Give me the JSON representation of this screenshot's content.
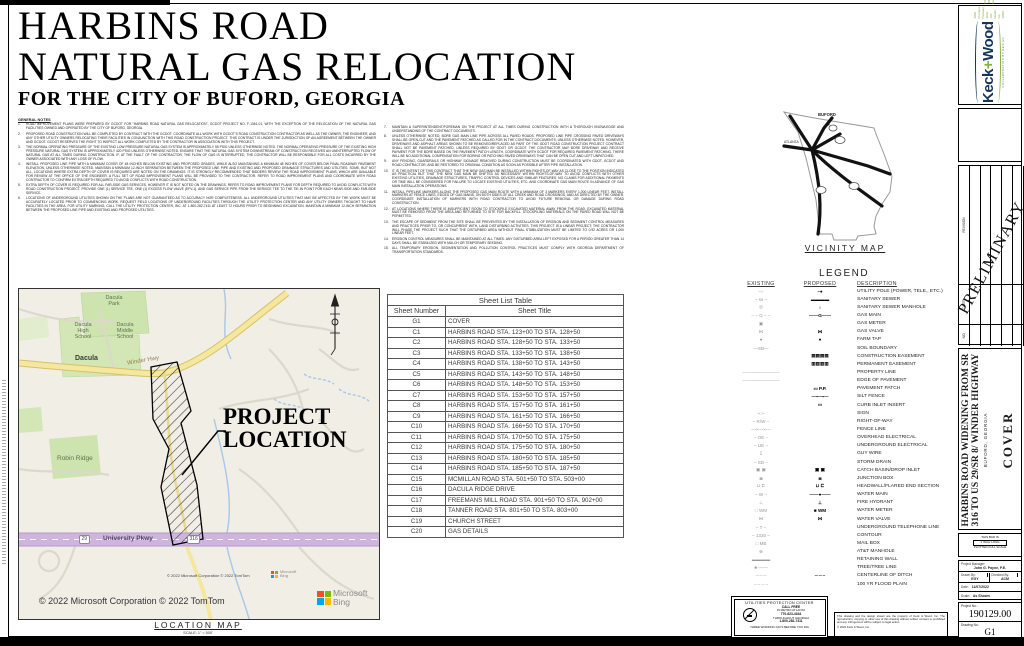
{
  "colors": {
    "keck_navy": "#15365a",
    "keck_green": "#86b33a",
    "map_hwy_yellow": "#f5e79e",
    "map_pkwy_purple": "#cfb5de",
    "park_green": "#cde4ae"
  },
  "sheet_title": {
    "line1": "HARBINS ROAD",
    "line2": "NATURAL GAS RELOCATION",
    "line3": "FOR THE CITY OF BUFORD, GEORGIA"
  },
  "general_notes": {
    "heading": "GENERAL NOTES",
    "col1": [
      {
        "n": "1.",
        "text": "ROAD IMPROVEMENT PLANS WERE PREPARED BY GCDOT FOR \"HARBINS ROAD NATURAL GAS RELOCATION\", GCDOT PROJECT NO. F-1361-01, WITH THE EXCEPTION OF THE RELOCATION OF THE NATURAL GAS FACILITIES OWNED AND OPERATED BY THE CITY OF BUFORD, GEORGIA."
      },
      {
        "n": "2.",
        "text": "PROPOSED ROAD CONSTRUCTION WILL BE COMPLETED BY CONTRACT WITH THE GCDOT. COORDINATE ALL WORK WITH GCDOT'S ROAD CONSTRUCTION CONTRACTOR AS WELL AS THE OWNER, THE ENGINEER, AND ANY OTHER UTILITY OWNERS RELOCATING THEIR FACILITIES IN CONJUNCTION WITH THIS ROAD CONSTRUCTION PROJECT. THIS CONTRACT IS UNDER THE JURISDICTION OF AN AGREEMENT BETWEEN THE OWNER AND GCDOT. GCDOT RESERVES THE RIGHT TO INSPECT ALL WORK COMPLETED BY THE CONTRACTOR IN ASSOCIATION WITH THIS PROJECT."
      },
      {
        "n": "3.",
        "text": "THE NORMAL OPERATING PRESSURE OF THE EXISTING LOW PRESSURE NATURAL GAS SYSTEM IS APPROXIMATELY 55 PSIG UNLESS OTHERWISE NOTED. THE NORMAL OPERATING PRESSURE OF THE EXISTING HIGH PRESSURE NATURAL GAS SYSTEM IS APPROXIMATELY 420 PSIG UNLESS OTHERWISE NOTED. ENSURE THAT THE NATURAL GAS SYSTEM DOWNSTREAM OF CONSTRUCTION RECEIVES AN UNINTERRUPTED FLOW OF NATURAL GAS AT ALL TIMES DURING CONSTRUCTION. IF, AT THE FAULT OF THE CONTRACTOR, THE FLOW OF GAS IS INTERRUPTED, THE CONTRACTOR WILL BE RESPONSIBLE FOR ALL COSTS INCURRED BY THE OWNER ASSOCIATED WITH ANY LOSS OF FLOW."
      },
      {
        "n": "4.",
        "text": "INSTALL PROPOSED LINE PIPE WITH A MINIMUM COVER OF 48 INCHES BELOW EXISTING AND PROPOSED GRADES, WHILE ALSO MAINTAINING A MINIMUM 48 INCHES OF COVER BELOW FINAL ROADWAY PAVEMENT ELEVATION, UNLESS OTHERWISE NOTED. MAINTAIN A MINIMUM 12-INCH SEPARATION BETWEEN THE PROPOSED LINE PIPE AND EXISTING AND PROPOSED DRAINAGE STRUCTURES AND UTILITIES. SOME, BUT NOT ALL, LOCATIONS WHERE EXTRA DEPTH OF COVER IS REQUIRED ARE NOTED ON THE DRAWINGS. IT IS STRONGLY RECOMMENDED THAT BIDDERS REVIEW THE ROAD IMPROVEMENT PLANS, WHICH ARE AVAILABLE FOR REVIEW AT THE OFFICE OF THE ENGINEER. A FULL SET OF ROAD IMPROVEMENT PLANS WILL BE PROVIDED TO THE CONTRACTOR. REFER TO ROAD IMPROVEMENT PLANS AND COORDINATE WITH ROAD CONTRACTOR TO CONFIRM EXTRA DEPTH REQUIRED TO AVOID CONFLICTS WITH ROAD CONSTRUCTION."
      },
      {
        "n": "5.",
        "text": "EXTRA DEPTH OF COVER IS REQUIRED FOR ALL FAR-SIDE GAS SERVICES, HOWEVER IT IS NOT NOTED ON THE DRAWINGS. REFER TO ROAD IMPROVEMENT PLANS FOR DEPTH REQUIRED TO AVOID CONFLICTS WITH ROAD CONSTRUCTION PROJECT. PROVIDE ONE (1) SERVICE TEE, ONE (1) EXCESS FLOW VALVE (EFV-1), AND GAS SERVICE PIPE FROM THE SERVICE TEE TO THE TIE-IN POINT FOR EACH NEAR-SIDE AND FAR-SIDE SERVICE."
      },
      {
        "n": "6.",
        "text": "LOCATIONS OF UNDERGROUND UTILITIES SHOWN ON THE PLANS ARE NOT GUARANTEED AS TO ACCURACY NOR COMPLETENESS. ALL UNDERGROUND UTILITIES THAT MAY BE AFFECTED BY THE WORK MUST BE ACCURATELY LOCATED PRIOR TO COMMENCING WORK. REQUEST FIELD LOCATIONS OF UNDERGROUND FACILITIES THROUGH THE UTILITY PROTECTION CENTER AND ANY UTILITY OWNERS THOUGHT TO HAVE FACILITIES IN THE AREA. FOR UTILITY MARKING, CALL THE UTILITY PROTECTION CENTER, INC. AT 1-800-282-7411 AT LEAST 72 HOURS PRIOR TO BEGINNING EXCAVATION. MAINTAIN A MINIMUM 12-INCH SEPARATION BETWEEN THE PROPOSED LINE PIPE AND EXISTING AND PROPOSED UTILITIES."
      }
    ],
    "col2": [
      {
        "n": "7.",
        "text": "MAINTAIN A SUPERINTENDENT/FOREMAN ON THE PROJECT AT ALL TIMES DURING CONSTRUCTION WITH A THOROUGH KNOWLEDGE AND UNDERSTANDING OF THE CONTRACT DOCUMENTS."
      },
      {
        "n": "8.",
        "text": "UNLESS OTHERWISE NOTED, BORE GAS MAIN LINE PIPE ACROSS ALL PAVED ROADS. PROPOSED LINE PIPE CROSSING PAVED DRIVEWAYS SHALL BE OPEN-CUT AND THE PAVEMENT PATCHED AS CALLED FOR IN THE CONTRACT DOCUMENTS, UNLESS OTHERWISE NOTED. HOWEVER, DRIVEWAYS AND ASPHALT AREAS SHOWN TO BE REMOVED/REPLACED AS PART OF THE GDOT ROAD CONSTRUCTION PROJECT CONTRACT SHALL NOT BE PAVEMENT PATCHED, UNLESS REQUIRED BY GDOT OR GCDOT. THE CONTRACTOR MAY BORE DRIVEWAY AND RECEIVE PAYMENT FOR THE BORE BASED ON THE PAVEMENT PATCH LENGTH. COORDINATE WITH GCDOT FOR REQUIRED PAVEMENT PATCHING. THERE WILL BE NO ADDITIONAL COMPENSATION FOR BORING OR PATCHING PAVED DRIVEWAYS THAT CAN BE OPEN CUT AND LEFT UNPATCHED."
      },
      {
        "n": "9.",
        "text": "ANY FENCING, GUARDRAILS OR HIGHWAY SIGNAGE REMOVED DURING CONSTRUCTION MUST BE COORDINATED WITH GDOT, GCDOT AND ROAD CONTRACTOR, AND BE RESTORED TO ORIGINAL CONDITION AS SOON AS POSSIBLE AFTER PIPE INSTALLATION."
      },
      {
        "n": "10.",
        "text": "IT IS THE INTENT OF THIS CONTRACT THAT THE NEW GAS MAIN BE INSTALLED WITHIN RIGHTS-OF-WAY AS CLOSE TO THE POSITION INDICATED AS PRACTICAL BUT THAT THE NEW GAS MAIN BE SHIFTED AS NECESSARY WITHIN RIGHTS-OF-WAY TO AVOID CONFLICTS WITH OTHER EXISTING UTILITIES, DRAINAGE STRUCTURES, TRAFFIC CONTROL DEVICES AND SIMILAR FEATURES. NO CLAIMS FOR ADDITIONAL PAYMENTS OR TIME WILL BE CONSIDERED FOR FAILURE TO LOCATE EXISTING UTILITIES, ETC. AND COORDINATE GAS MAIN ROUTE IN ADVANCE OF GAS MAIN INSTALLATION OPERATIONS."
      },
      {
        "n": "11.",
        "text": "INSTALL PIPELINE MARKERS ALONG THE PROPOSED GAS MAIN ROUTE WITH A MINIMUM OF 3 MARKERS EVERY 1,000 LINEAR FEET. INSTALL MARKERS AT FENCE LINES, EDGES OF GAS MAINS, ON BOTH SIDES OF ALL CREEK AND ROAD CROSSINGS, AND AS DIRECTED BY THE OWNER. COORDINATE INSTALLATION OF MARKERS WITH ROAD CONTRACTOR TO AVOID FUTURE REMOVAL OR DAMAGE DURING ROAD CONSTRUCTION."
      },
      {
        "n": "12.",
        "text": "AT LOCATIONS WHERE THERE IS INSUFFICIENT ROOM TO STOCKPILE EXCAVATED MATERIAL AWAY FROM THE ROAD, EXCAVATED MATERIAL MUST BE REMOVED FROM THE AREA AND RETURNED TO SITE FOR BACKFILL. STOCKPILING MATERIALS ON THE PAVED ROAD WILL NOT BE PERMITTED."
      },
      {
        "n": "13.",
        "text": "THE ESCAPE OF SEDIMENT FROM THE SITE SHALL BE PREVENTED BY THE INSTALLATION OF EROSION AND SEDIMENT CONTROL MEASURES AND PRACTICES PRIOR TO, OR CONCURRENT WITH, LAND DISTURBING ACTIVITIES. THIS PROJECT IS A LINEAR PROJECT; THE CONTRACTOR WILL PHASE THE PROJECT SUCH THAT THE DISTURBED AREA WITHOUT FINAL STABILIZATION MUST BE LIMITED TO 0.92 ACRES OR 1,000 LINEAR FEET."
      },
      {
        "n": "14.",
        "text": "EROSION CONTROL MEASURES SHALL BE MAINTAINED AT ALL TIMES. ANY DISTURBED AREA LEFT EXPOSED FOR A PERIOD GREATER THAN 14 DAYS SHALL BE STABILIZED WITH MULCH OR TEMPORARY SEEDING."
      },
      {
        "n": "15.",
        "text": "ALL TEMPORARY EROSION, SEDIMENTATION AND POLLUTION CONTROL PRACTICES MUST COMPLY WITH GEORGIA DEPARTMENT OF TRANSPORTATION STANDARDS."
      }
    ]
  },
  "sheet_list": {
    "title": "Sheet List Table",
    "col_number": "Sheet Number",
    "col_title": "Sheet Title",
    "rows": [
      {
        "num": "G1",
        "title": "COVER"
      },
      {
        "num": "C1",
        "title": "HARBINS ROAD STA. 123+00 TO STA. 128+50"
      },
      {
        "num": "C2",
        "title": "HARBINS ROAD STA. 128+50 TO STA. 133+50"
      },
      {
        "num": "C3",
        "title": "HARBINS ROAD STA. 133+50 TO STA. 138+50"
      },
      {
        "num": "C4",
        "title": "HARBINS ROAD STA. 138+50 TO STA. 143+50"
      },
      {
        "num": "C5",
        "title": "HARBINS ROAD STA. 143+50 TO STA. 148+50"
      },
      {
        "num": "C6",
        "title": "HARBINS ROAD STA. 148+50 TO STA. 153+50"
      },
      {
        "num": "C7",
        "title": "HARBINS ROAD STA. 153+50 TO STA. 157+50"
      },
      {
        "num": "C8",
        "title": "HARBINS ROAD STA. 157+50 TO STA. 161+50"
      },
      {
        "num": "C9",
        "title": "HARBINS ROAD STA. 161+50 TO STA. 166+50"
      },
      {
        "num": "C10",
        "title": "HARBINS ROAD STA. 166+50 TO STA. 170+50"
      },
      {
        "num": "C11",
        "title": "HARBINS ROAD STA. 170+50 TO STA. 175+50"
      },
      {
        "num": "C12",
        "title": "HARBINS ROAD STA. 175+50 TO STA. 180+50"
      },
      {
        "num": "C13",
        "title": "HARBINS ROAD STA. 180+50 TO STA. 185+50"
      },
      {
        "num": "C14",
        "title": "HARBINS ROAD STA. 185+50 TO STA. 187+50"
      },
      {
        "num": "C15",
        "title": "MCMILLAN ROAD STA. 501+50 TO STA. 503+00"
      },
      {
        "num": "C16",
        "title": "DACULA RIDGE DRIVE"
      },
      {
        "num": "C17",
        "title": "FREEMANS MILL ROAD STA. 901+50 TO STA. 902+00"
      },
      {
        "num": "C18",
        "title": "TANNER ROAD STA. 801+50 TO STA. 803+00"
      },
      {
        "num": "C19",
        "title": "CHURCH STREET"
      },
      {
        "num": "C20",
        "title": "GAS DETAILS"
      }
    ]
  },
  "vicinity": {
    "caption": "VICINITY MAP",
    "buford": "BUFORD",
    "atlanta": "ATLANTA"
  },
  "legend": {
    "title": "LEGEND",
    "h_existing": "EXISTING",
    "h_proposed": "PROPOSED",
    "h_description": "DESCRIPTION",
    "rows": [
      {
        "ex": "–○",
        "pr": "–●",
        "desc": "UTILITY POLE (POWER, TELE., ETC.)"
      },
      {
        "ex": "– ss –",
        "pr": "▬▬▬▬",
        "desc": "SANITARY SEWER"
      },
      {
        "ex": "◎",
        "pr": "○",
        "desc": "SANITARY SEWER MANHOLE"
      },
      {
        "ex": "– – G – –",
        "pr": "——G——",
        "desc": "GAS MAIN"
      },
      {
        "ex": "▣",
        "pr": "",
        "desc": "GAS METER"
      },
      {
        "ex": "⋈",
        "pr": "⋈",
        "desc": "GAS VALVE"
      },
      {
        "ex": "●",
        "pr": "●",
        "desc": "FARM TAP"
      },
      {
        "ex": "—SB—",
        "pr": "",
        "desc": "SOIL BOUNDARY"
      },
      {
        "ex": "",
        "pr": "▤▤▤▤",
        "desc": "CONSTRUCTION EASEMENT"
      },
      {
        "ex": "",
        "pr": "▥▥▥▥",
        "desc": "PERMANENT EASEMENT"
      },
      {
        "ex": "————————",
        "pr": "",
        "desc": "PROPERTY LINE"
      },
      {
        "ex": "————————",
        "pr": "",
        "desc": "EDGE OF PAVEMENT"
      },
      {
        "ex": "",
        "pr": "▭ P.P.",
        "desc": "PAVEMENT PATCH"
      },
      {
        "ex": "",
        "pr": "—▪—▪—",
        "desc": "SILT FENCE"
      },
      {
        "ex": "",
        "pr": "▭",
        "desc": "CURB INLET INSERT"
      },
      {
        "ex": "–□–",
        "pr": "",
        "desc": "SIGN"
      },
      {
        "ex": "– R/W –",
        "pr": "",
        "desc": "RIGHT-OF-WAY"
      },
      {
        "ex": "—×—×—",
        "pr": "",
        "desc": "FENCE LINE"
      },
      {
        "ex": "– OE –",
        "pr": "",
        "desc": "OVERHEAD ELECTRICAL"
      },
      {
        "ex": "– UE –",
        "pr": "",
        "desc": "UNDERGROUND ELECTRICAL"
      },
      {
        "ex": "↧",
        "pr": "",
        "desc": "GUY WIRE"
      },
      {
        "ex": "– SD –",
        "pr": "",
        "desc": "STORM DRAIN"
      },
      {
        "ex": "▣ ▣",
        "pr": "▣ ▣",
        "desc": "CATCH BASIN/DROP INLET"
      },
      {
        "ex": "◙",
        "pr": "◙",
        "desc": "JUNCTION BOX"
      },
      {
        "ex": "⊔ ⊏",
        "pr": "⊔ ⊏",
        "desc": "HEADWALL/FLARED END SECTION"
      },
      {
        "ex": "– W –",
        "pr": "——●——",
        "desc": "WATER MAIN"
      },
      {
        "ex": "⊥",
        "pr": "⊥",
        "desc": "FIRE HYDRANT"
      },
      {
        "ex": "□ WM",
        "pr": "■ WM",
        "desc": "WATER METER"
      },
      {
        "ex": "⋈",
        "pr": "⋈",
        "desc": "WATER VALVE"
      },
      {
        "ex": "– T –",
        "pr": "",
        "desc": "UNDERGROUND TELEPHONE LINE"
      },
      {
        "ex": "– 1330 –",
        "pr": "",
        "desc": "CONTOUR"
      },
      {
        "ex": "□ MB",
        "pr": "",
        "desc": "MAIL BOX"
      },
      {
        "ex": "⊕",
        "pr": "",
        "desc": "AT&T MANHOLE"
      },
      {
        "ex": "▬▬▬▬",
        "pr": "",
        "desc": "RETAINING WALL"
      },
      {
        "ex": "♣ ——",
        "pr": "",
        "desc": "TREE/TREE LINE"
      },
      {
        "ex": "–·–·–",
        "pr": "–·–·–",
        "desc": "CENTERLINE OF DITCH"
      },
      {
        "ex": "– – – –",
        "pr": "",
        "desc": "100 YR FLOOD PLAIN"
      }
    ]
  },
  "location_map": {
    "labels": {
      "dacula_park": "Dacula\nPark",
      "dacula_high": "Dacula\nHigh\nSchool",
      "dacula_middle": "Dacula\nMiddle\nSchool",
      "dacula": "Dacula",
      "winder_hwy": "Winder Hwy",
      "robin_ridge": "Robin Ridge",
      "university_pkwy": "University Pkwy",
      "shield_29": "29",
      "shield_316": "316"
    },
    "callout": "PROJECT\nLOCATION",
    "attribution_small": "© 2022 Microsoft Corporation © 2022 TomTom",
    "attribution_large": "© 2022 Microsoft Corporation © 2022 TomTom",
    "bing_line1": "Microsoft",
    "bing_line2": "Bing",
    "caption": "LOCATION MAP",
    "scale": "SCALE: 1\" = 500'"
  },
  "upc": {
    "title": "UTILITIES PROTECTION CENTER",
    "call_free": "CALL FREE",
    "metro": "IN METRO ATLANTA",
    "phone_metro": "770-623-4344",
    "throughout": "THROUGHOUT GEORGIA",
    "phone_ga": "1-800-282-7411",
    "bottom": "THREE WORKING DAYS BEFORE YOU DIG"
  },
  "copyright": {
    "text": "This drawing and the design shown are the property of Keck & Wood, Inc. The reproduction, copying or other use of this drawing without written consent is prohibited and any infringement will be subject to legal action.",
    "line2": "© 2022 Keck & Wood, Inc."
  },
  "titleblock": {
    "firm": {
      "keck": "Keck",
      "plus": "+",
      "wood": "Wood",
      "tagline": "COLLABORATION BY DESIGN",
      "addr1": "3090 Premiere Parkway, Suite 200",
      "addr2": "Duluth, GA 30097",
      "phone": "(678) 417-4000",
      "web": "keckwood.com"
    },
    "preliminary": "PRELIMINARY",
    "rev_no": "NO.",
    "rev_date": "DATE",
    "rev_revision": "REVISION",
    "project_title1": "HARBINS ROAD WIDENING FROM SR",
    "project_title2": "316 TO US 29/SR 8/ WINDER HIGHWAY",
    "project_city": "BUFORD, GEORGIA",
    "sheet_name": "COVER",
    "scalebar_l1": "THIS BAR IS",
    "scalebar_l2": "1 INCH LONG",
    "scalebar_l3": "PLOTTED FULL SCALE",
    "pm_label": "Project Manager:",
    "pm": "John G. Payne, P.E.",
    "drawn_label": "Drawn By:",
    "drawn": "EGY",
    "checked_label": "Checked By:",
    "checked": "ACM",
    "date_label": "Date:",
    "date": "11/07/2022",
    "scale_label": "Scale:",
    "scale": "As Shown",
    "projno_label": "Project No.:",
    "projno": "190129.00",
    "dwgno_label": "Drawing No.:",
    "dwgno": "G1"
  }
}
